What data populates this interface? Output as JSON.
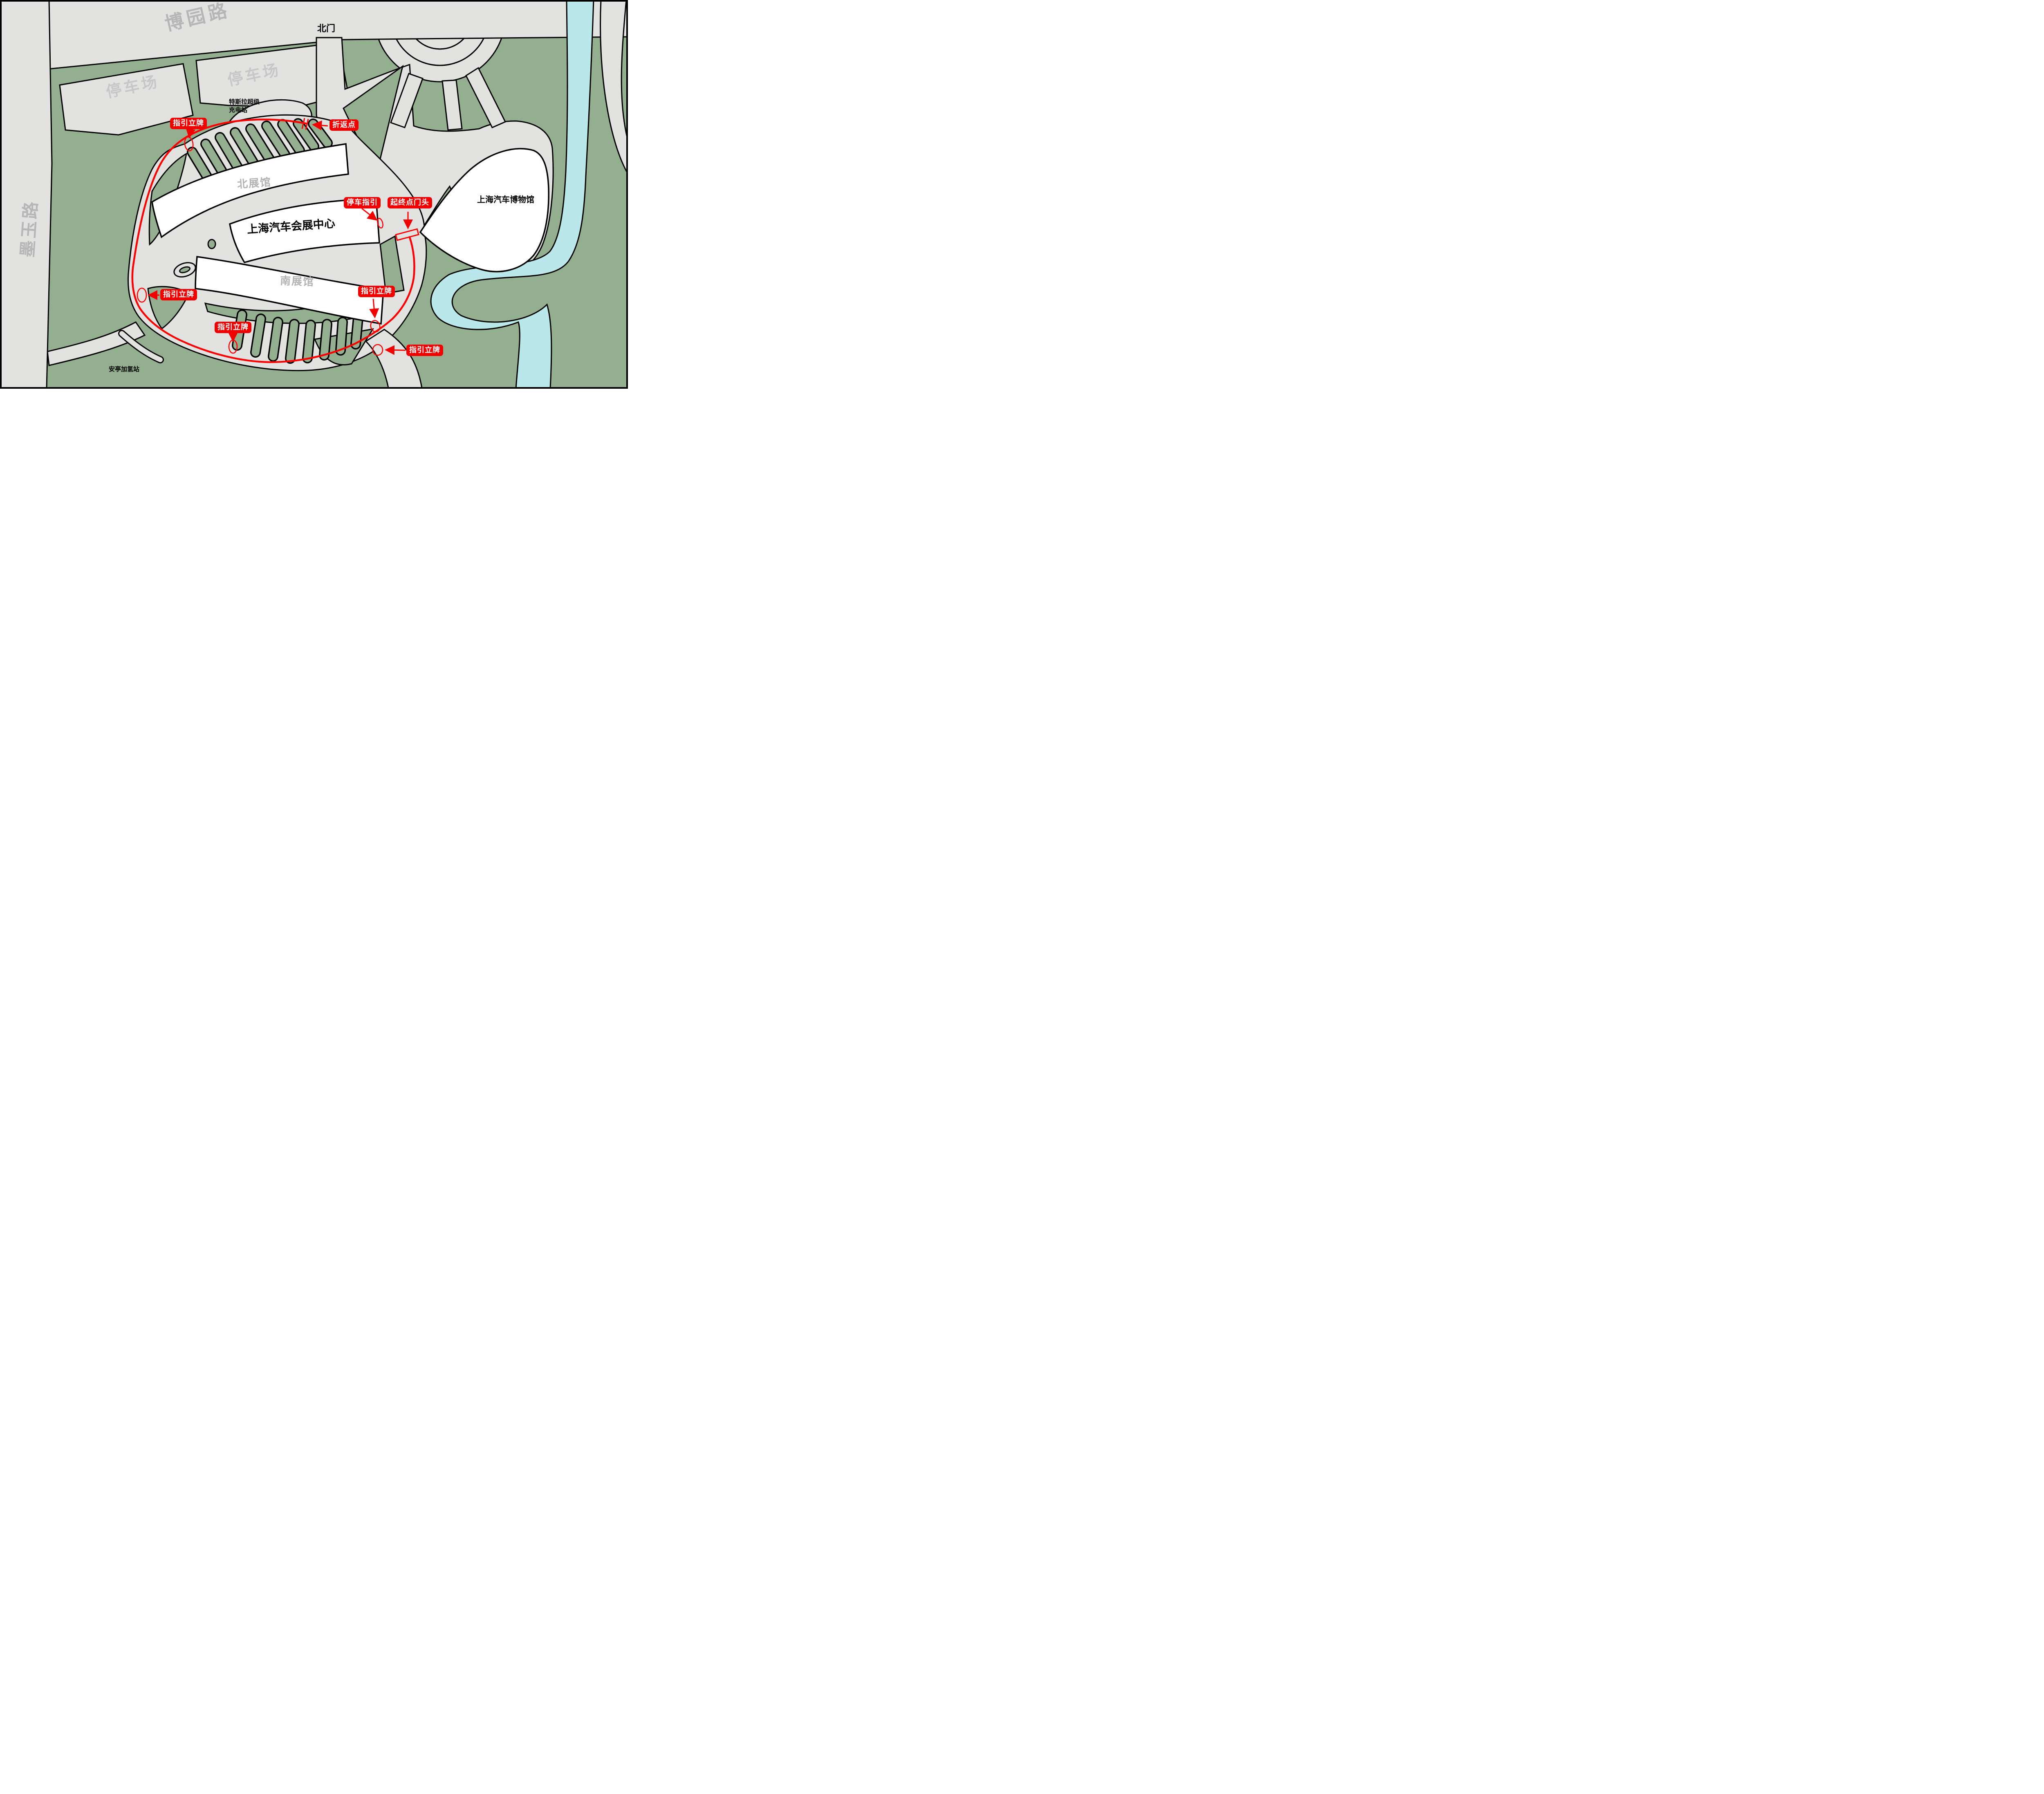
{
  "roads": {
    "boyuan": "博园路",
    "moyu": "墨玉路"
  },
  "entrances": {
    "north_gate": "北门"
  },
  "areas": {
    "parking_west": "停车场",
    "parking_north": "停车场",
    "tesla_supercharger": "特斯拉超级\n充电站",
    "hydrogen_station": "安亭加氢站"
  },
  "buildings": {
    "north_hall": "北展馆",
    "expo_center": "上海汽车会展中心",
    "south_hall": "南展馆",
    "auto_museum": "上海汽车博物馆"
  },
  "route_annotations": {
    "guide_sign_1": "指引立牌",
    "guide_sign_2": "指引立牌",
    "guide_sign_3": "指引立牌",
    "guide_sign_4": "指引立牌",
    "guide_sign_5": "指引立牌",
    "turnaround_point": "折返点",
    "parking_guide": "停车指引",
    "start_end_gate": "起终点门头"
  },
  "colors": {
    "green_land": "#94af8f",
    "road_gray": "#e2e2e0",
    "water_blue": "#b9e7ea",
    "annotation_red": "#f40000",
    "route_red": "#ff0000",
    "road_text_gray": "#bcbcbc",
    "building_white": "#ffffff",
    "outline_black": "#000000"
  }
}
